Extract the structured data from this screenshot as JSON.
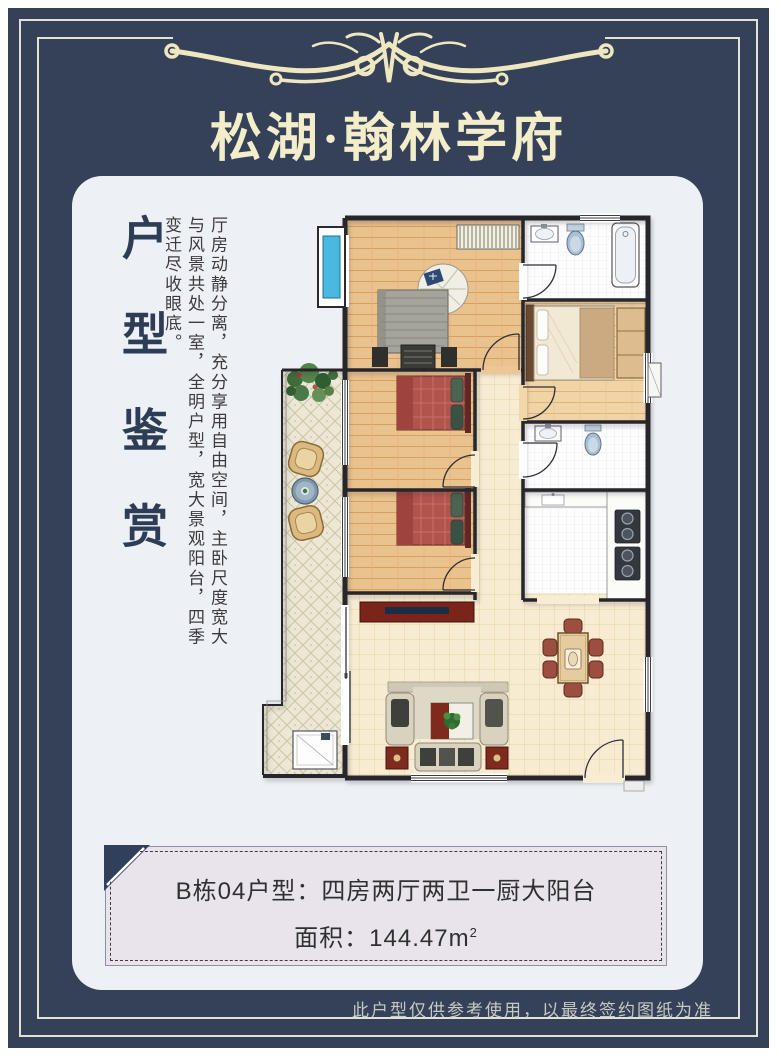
{
  "header": {
    "project_name": "松湖·翰林学府"
  },
  "gallery_card": {
    "section_title": "户型鉴赏",
    "description": "厅房动静分离，充分享用自由空间，主卧尺度宽大与风景共处一室，全明户型，宽大景观阳台，四季变迁尽收眼底。"
  },
  "info_panel": {
    "unit_line": "B栋04户型：四房两厅两卫一厨大阳台",
    "area_label": "面积：144.47m",
    "area_superscript": "2"
  },
  "footer": {
    "disclaimer": "此户型仅供参考使用，以最终签约图纸为准"
  },
  "colors": {
    "background_navy": "#344159",
    "gold_accent": "#efe7c0",
    "card_background": "#edf1f5",
    "panel_background": "#e9e4ec",
    "wood_floor": "#eac28d",
    "tile_floor": "#f7ecd2",
    "bay_window_blue": "#49b9e2"
  },
  "floorplan": {
    "rooms": [
      "master-bedroom",
      "bedroom-2",
      "bedroom-3",
      "bedroom-right",
      "bathroom-1",
      "bathroom-2",
      "kitchen",
      "corridor",
      "living-room",
      "dining-area",
      "balcony"
    ]
  }
}
